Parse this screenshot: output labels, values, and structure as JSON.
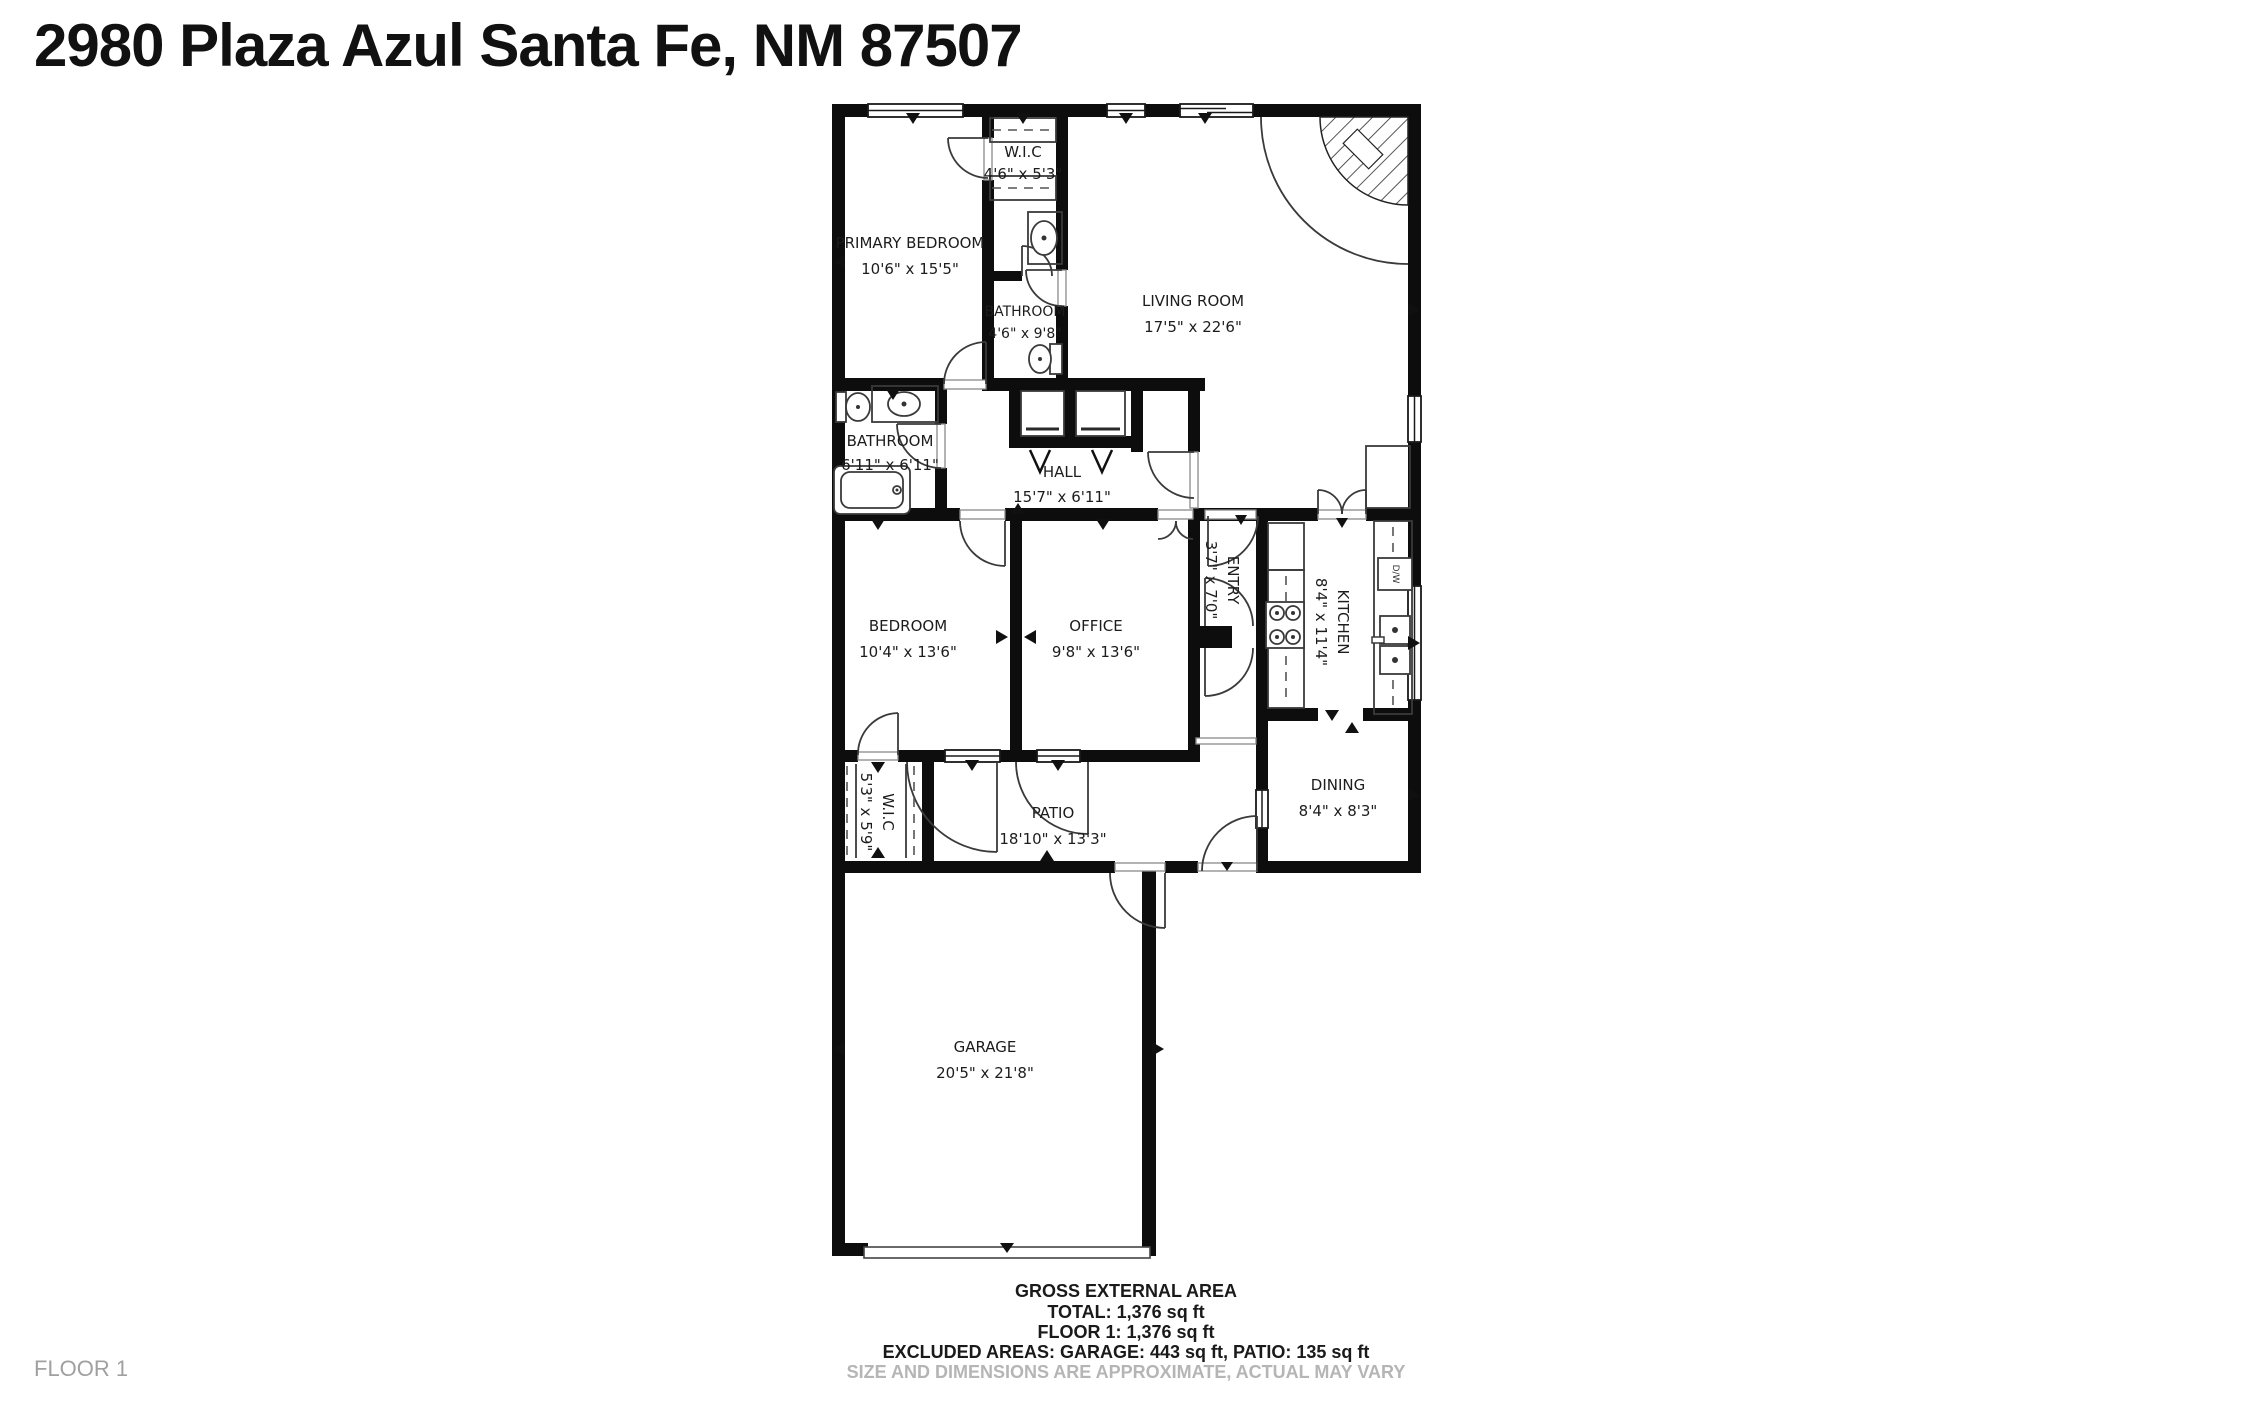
{
  "header": {
    "title": "2980 Plaza Azul Santa Fe, NM 87507"
  },
  "floor_plan": {
    "floor_label_watermark": "FLOOR 1",
    "kitchen_appliance_label": "D/W",
    "rooms": [
      {
        "id": "wic-top",
        "name": "W.I.C",
        "dims": "4'6\" x 5'3\"",
        "orientation": "horizontal"
      },
      {
        "id": "primary-bedroom",
        "name": "PRIMARY BEDROOM",
        "dims": "10'6\" x 15'5\"",
        "orientation": "horizontal"
      },
      {
        "id": "bathroom-primary",
        "name": "BATHROOM",
        "dims": "4'6\" x 9'8\"",
        "orientation": "horizontal"
      },
      {
        "id": "living-room",
        "name": "LIVING ROOM",
        "dims": "17'5\" x 22'6\"",
        "orientation": "horizontal"
      },
      {
        "id": "bathroom-hall",
        "name": "BATHROOM",
        "dims": "6'11\" x 6'11\"",
        "orientation": "horizontal"
      },
      {
        "id": "hall",
        "name": "HALL",
        "dims": "15'7\" x 6'11\"",
        "orientation": "horizontal"
      },
      {
        "id": "entry",
        "name": "ENTRY",
        "dims": "3'7\" x 7'0\"",
        "orientation": "vertical"
      },
      {
        "id": "kitchen",
        "name": "KITCHEN",
        "dims": "8'4\" x 11'4\"",
        "orientation": "vertical"
      },
      {
        "id": "bedroom",
        "name": "BEDROOM",
        "dims": "10'4\" x 13'6\"",
        "orientation": "horizontal"
      },
      {
        "id": "office",
        "name": "OFFICE",
        "dims": "9'8\" x 13'6\"",
        "orientation": "horizontal"
      },
      {
        "id": "wic-lower",
        "name": "W.I.C",
        "dims": "5'3\" x 5'9\"",
        "orientation": "vertical"
      },
      {
        "id": "patio",
        "name": "PATIO",
        "dims": "18'10\" x 13'3\"",
        "orientation": "horizontal"
      },
      {
        "id": "dining",
        "name": "DINING",
        "dims": "8'4\" x 8'3\"",
        "orientation": "horizontal"
      },
      {
        "id": "garage",
        "name": "GARAGE",
        "dims": "20'5\" x 21'8\"",
        "orientation": "horizontal"
      }
    ]
  },
  "footer": {
    "area_heading": "GROSS EXTERNAL AREA",
    "total": "TOTAL: 1,376 sq ft",
    "floor_total": "FLOOR 1: 1,376 sq ft",
    "excluded": "EXCLUDED AREAS: GARAGE: 443 sq ft, PATIO: 135 sq ft",
    "disclaimer": "SIZE AND DIMENSIONS ARE APPROXIMATE, ACTUAL MAY VARY"
  },
  "colors": {
    "background": "#ffffff",
    "walls": "#0d0d0d",
    "fixture_lines": "#3a3a3a",
    "muted_text": "#b5b5b5",
    "watermark_text": "#a0a0a0"
  }
}
